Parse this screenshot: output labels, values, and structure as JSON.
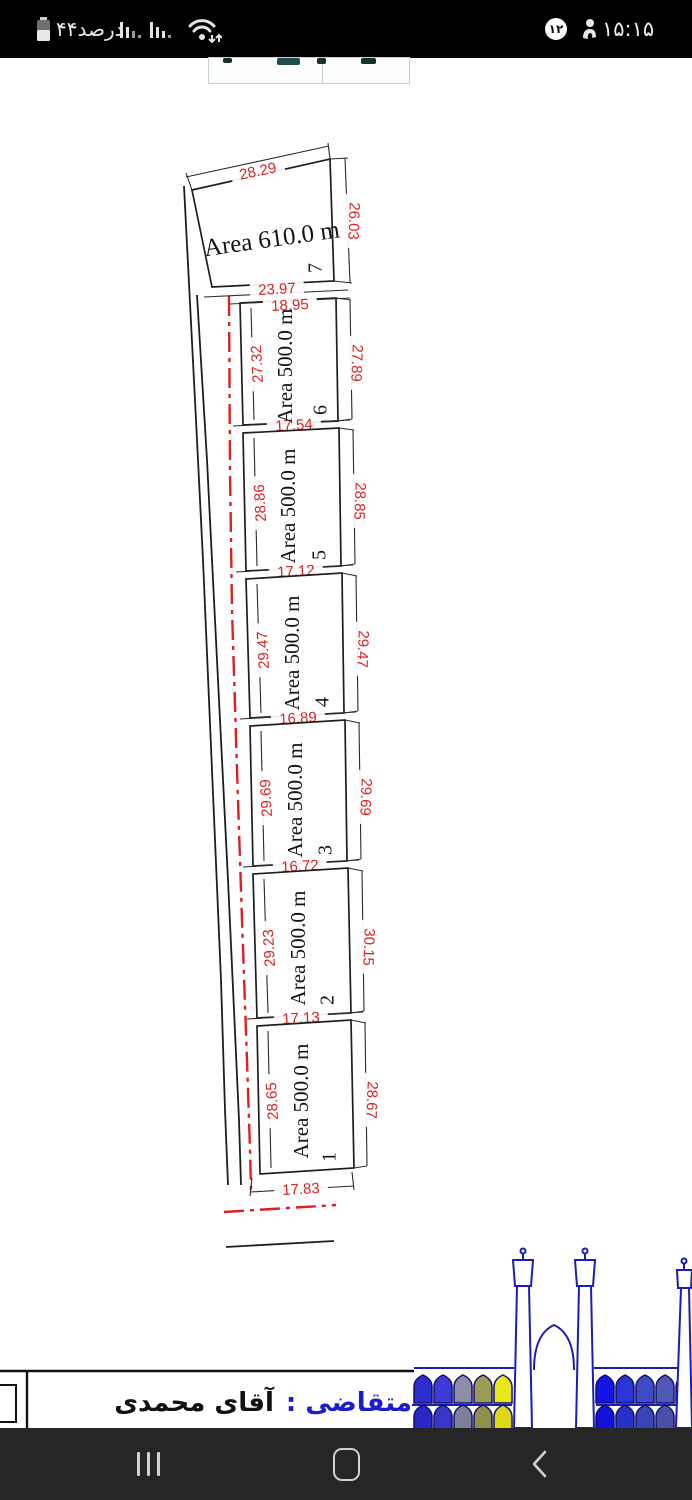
{
  "status_bar": {
    "battery_label": "۴۴درصد",
    "badge_count": "۱۲",
    "time": "۱۵:۱۵"
  },
  "drawing": {
    "plots": [
      {
        "number": "7",
        "area_label": "Area 610.0 m",
        "dim_top": "28.29",
        "dim_right": "26.03",
        "dim_bottom": "23.97"
      },
      {
        "number": "6",
        "area_label": "Area 500.0 m",
        "dim_top": "18.95",
        "dim_left": "27.32",
        "dim_right": "27.89",
        "dim_bottom": "17.54"
      },
      {
        "number": "5",
        "area_label": "Area 500.0 m",
        "dim_left": "28.86",
        "dim_right": "28.85",
        "dim_bottom": "17.12"
      },
      {
        "number": "4",
        "area_label": "Area 500.0 m",
        "dim_left": "29.47",
        "dim_right": "29.47",
        "dim_bottom": "16.89"
      },
      {
        "number": "3",
        "area_label": "Area 500.0 m",
        "dim_left": "29.69",
        "dim_right": "29.69",
        "dim_bottom": "16.72"
      },
      {
        "number": "2",
        "area_label": "Area 500.0 m",
        "dim_left": "29.23",
        "dim_right": "30.15",
        "dim_bottom": "17.13"
      },
      {
        "number": "1",
        "area_label": "Area 500.0 m",
        "dim_left": "28.65",
        "dim_right": "28.67",
        "dim_bottom": "17.83"
      }
    ]
  },
  "title_block": {
    "label": "متقاضی :",
    "value": "آقای محمدی"
  },
  "colors": {
    "dim_red": "#dd2222",
    "centerline_red": "#e02020",
    "line_black": "#1e1e1e",
    "title_label_blue": "#1c1ccc",
    "mosque_outline": "#1c1cb8",
    "status_bg": "#000000",
    "nav_bg": "#262626",
    "arcade_left_top": [
      "#2d2dd0",
      "#3c3cd4",
      "#8d8da6",
      "#9c9c50",
      "#e8e818"
    ],
    "arcade_left_bottom": [
      "#2828c4",
      "#3737c9",
      "#7f7f97",
      "#90904a",
      "#ddd716"
    ],
    "arcade_right_top": [
      "#1414e6",
      "#2a35d6",
      "#3f4cc6",
      "#4f58b4",
      "#5a5fa6"
    ],
    "arcade_right_bottom": [
      "#1212d8",
      "#2730c8",
      "#3a45b8",
      "#4850a8",
      "#53589a"
    ]
  }
}
